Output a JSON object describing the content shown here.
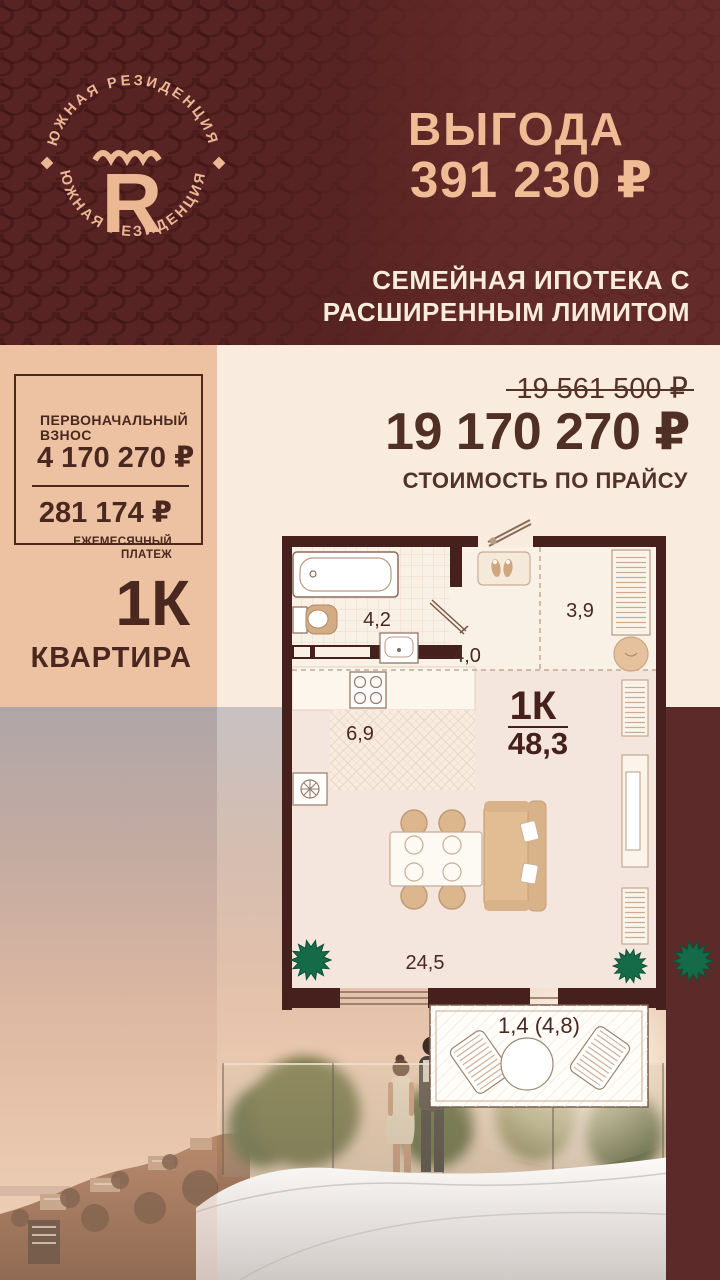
{
  "header": {
    "logo": {
      "brand_top": "ЮЖНАЯ РЕЗИДЕНЦИЯ",
      "brand_bottom": "ЮЖНАЯ РЕЗИДЕНЦИЯ",
      "monogram": "R"
    },
    "benefit_label": "ВЫГОДА",
    "benefit_amount": "391 230 ₽",
    "mortgage_line1": "СЕМЕЙНАЯ ИПОТЕКА С",
    "mortgage_line2": "РАСШИРЕННЫМ ЛИМИТОМ"
  },
  "payment": {
    "down_label1": "ПЕРВОНАЧАЛЬНЫЙ",
    "down_label2": "ВЗНОС",
    "down_value": "4 170 270 ₽",
    "monthly_value": "281 174 ₽",
    "monthly_label1": "ЕЖЕМЕСЯЧНЫЙ",
    "monthly_label2": "ПЛАТЕЖ"
  },
  "apartment": {
    "type": "1К",
    "kind": "КВАРТИРА"
  },
  "price": {
    "old": "19 561 500 ₽",
    "new": "19 170 270 ₽",
    "caption": "СТОИМОСТЬ ПО ПРАЙСУ"
  },
  "plan": {
    "bathroom": "4,2",
    "hall": "4,0",
    "entry": "3,9",
    "kitchen": "6,9",
    "type": "1К",
    "total": "48,3",
    "living": "24,5",
    "balcony": "1,4 (4,8)"
  },
  "colors": {
    "brand_maroon": "#5c2626",
    "panel_peach": "#edc2a2",
    "background_cream": "#f9ecdf",
    "accent_peach_text": "#f0bc96",
    "dark_brown_text": "#4a281f",
    "plan_wall": "#45201d",
    "plant_green": "#156a47"
  }
}
